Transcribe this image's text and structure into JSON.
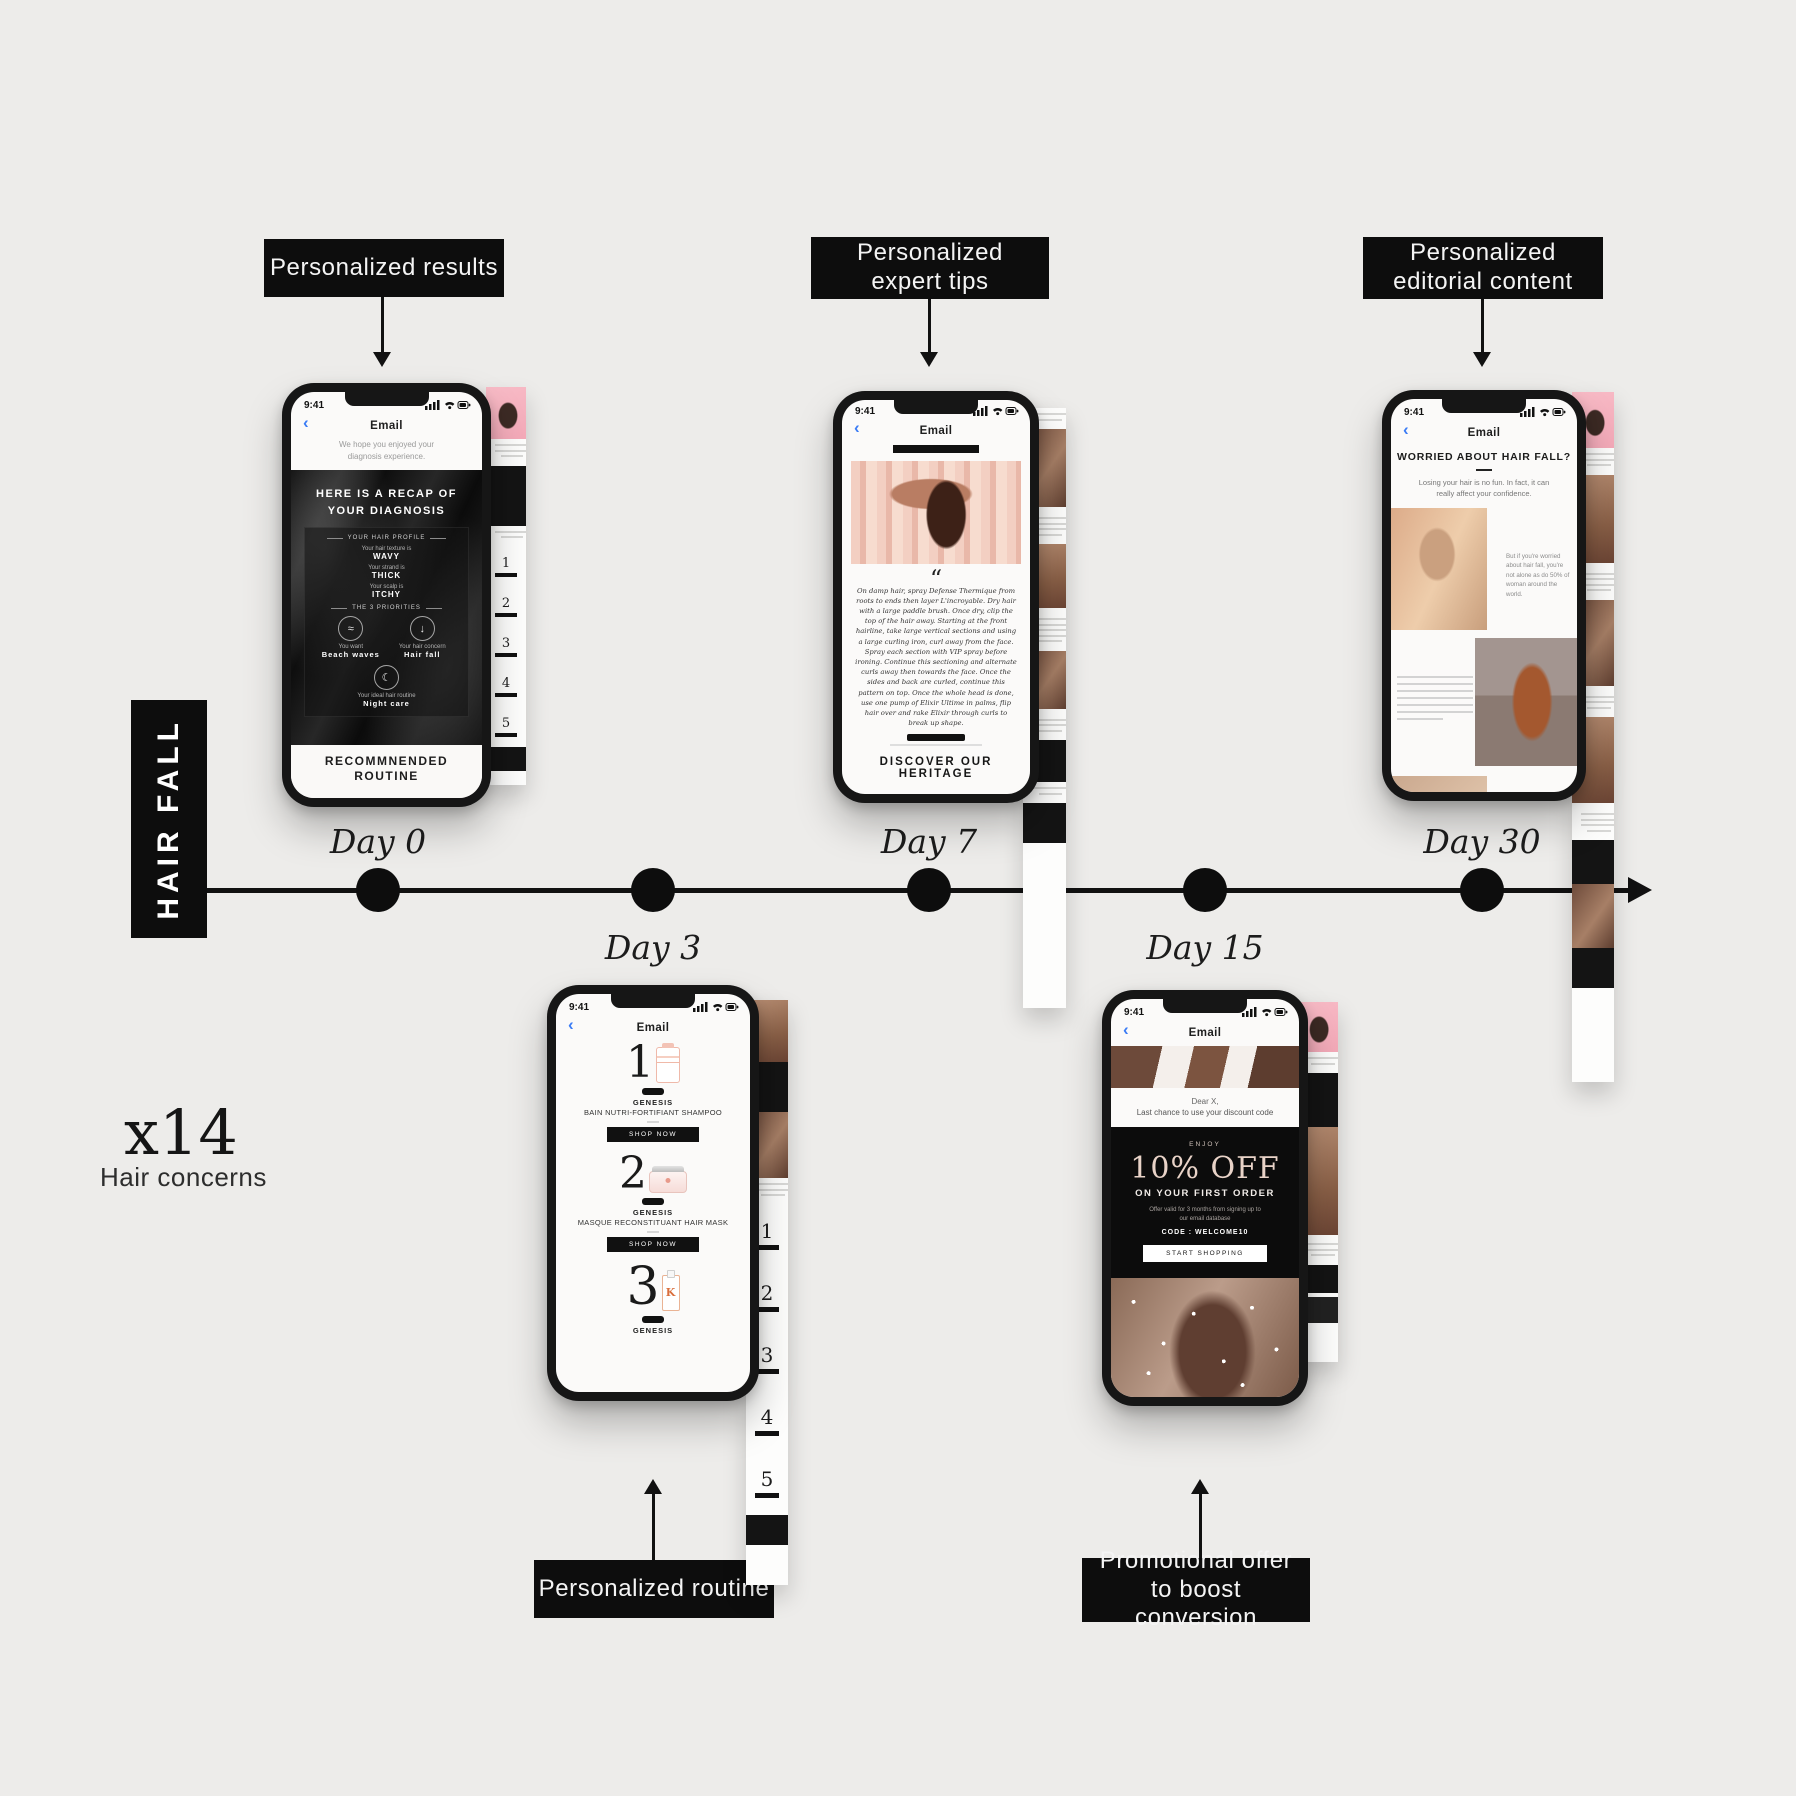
{
  "diagram": {
    "category": "HAIR FALL",
    "multiplier": "x14",
    "multiplier_caption": "Hair concerns",
    "timeline": {
      "days": [
        "Day 0",
        "Day 3",
        "Day 7",
        "Day 15",
        "Day 30"
      ]
    },
    "annotations": {
      "results": "Personalized results",
      "tips": "Personalized expert tips",
      "editorial": "Personalized editorial content",
      "routine": "Personalized routine",
      "promo": "Promotional offer to boost conversion"
    }
  },
  "colors": {
    "background": "#edecea",
    "annotation_bg": "#0d0d0d",
    "accent_blue": "#3b7cf5",
    "pink": "#f5b3c0",
    "rose_text": "#e9d3c8"
  },
  "phone_common": {
    "status_time": "9:41",
    "back_glyph": "‹",
    "nav_title": "Email"
  },
  "phone_day0": {
    "intro": "We hope you enjoyed your diagnosis experience.",
    "hero_title": "HERE IS A RECAP OF YOUR DIAGNOSIS",
    "profile_header": "YOUR HAIR PROFILE",
    "profile_rows": [
      {
        "label": "Your hair texture is",
        "value": "WAVY"
      },
      {
        "label": "Your strand is",
        "value": "THICK"
      },
      {
        "label": "Your scalp is",
        "value": "ITCHY"
      }
    ],
    "priorities_header": "THE 3 PRIORITIES",
    "priorities": [
      {
        "glyph": "≈",
        "label": "You want",
        "value": "Beach waves"
      },
      {
        "glyph": "↓",
        "label": "Your hair concern",
        "value": "Hair fall"
      },
      {
        "glyph": "☾",
        "label": "Your ideal hair routine",
        "value": "Night care"
      }
    ],
    "footer": "RECOMMNENDED ROUTINE"
  },
  "phone_day3": {
    "products": [
      {
        "number": "1",
        "brand": "GENESIS",
        "name": "BAIN NUTRI-FORTIFIANT SHAMPOO",
        "cta": "SHOP NOW"
      },
      {
        "number": "2",
        "brand": "GENESIS",
        "name": "MASQUE RECONSTITUANT HAIR MASK",
        "cta": "SHOP NOW"
      },
      {
        "number": "3",
        "brand": "GENESIS"
      }
    ]
  },
  "phone_day7": {
    "quote_mark": "“",
    "quote": "On damp hair, spray Defense Thermique from roots to ends then layer L'incroyable. Dry hair with a large paddle brush. Once dry, clip the top of the hair away. Starting at the front hairline, take large vertical sections and using a large curling iron, curl away from the face. Spray each section with VIP spray before ironing. Continue this sectioning and alternate curls away then towards the face. Once the sides and back are curled, continue this pattern on top. Once the whole head is done, use one pump of Elixir Ultime in palms, flip hair over and rake Elixir through curls to break up shape.",
    "footer": "DISCOVER OUR HERITAGE"
  },
  "phone_day15": {
    "greeting": "Dear X,",
    "subline": "Last chance to use your discount code",
    "eyebrow": "ENJOY",
    "offer": "10% OFF",
    "offer_sub": "ON YOUR FIRST ORDER",
    "terms": "Offer valid for 3 months from signing up to our email database",
    "code": "CODE : WELCOME10",
    "cta": "START SHOPPING"
  },
  "phone_day30": {
    "headline": "WORRIED ABOUT HAIR FALL?",
    "subline": "Losing your hair is no fun. In fact, it can really affect your confidence.",
    "fact": "But if you're worried about hair fall, you're not alone as do 50% of woman around the world."
  }
}
